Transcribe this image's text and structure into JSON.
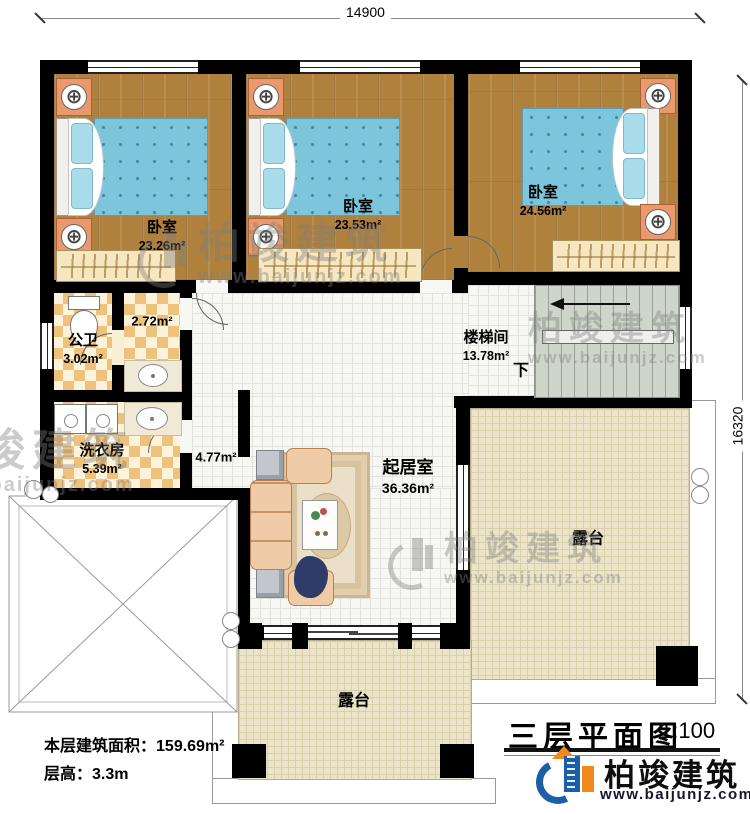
{
  "dimensions": {
    "width_top": "14900",
    "height_right": "16320"
  },
  "rooms": {
    "bedroom1": {
      "name": "卧室",
      "area": "23.26m²"
    },
    "bedroom2": {
      "name": "卧室",
      "area": "23.53m²"
    },
    "bedroom3": {
      "name": "卧室",
      "area": "24.56m²"
    },
    "bathroom": {
      "name": "公卫",
      "area": "3.02m²"
    },
    "vanity": {
      "area": "2.72m²"
    },
    "laundry": {
      "name": "洗衣房",
      "area": "5.39m²"
    },
    "hall": {
      "area": "4.77m²"
    },
    "stairwell": {
      "name": "楼梯间",
      "area": "13.78m²",
      "down_label": "下"
    },
    "living": {
      "name": "起居室",
      "area": "36.36m²"
    },
    "terrace_right": {
      "name": "露台"
    },
    "terrace_bottom": {
      "name": "露台"
    }
  },
  "footer": {
    "area_label": "本层建筑面积：",
    "area_value": "159.69m²",
    "height_label": "层高：",
    "height_value": "3.3m"
  },
  "title_block": {
    "title": "三层平面图",
    "scale": "1:100",
    "brand": "柏竣建筑",
    "website": "www.baijunjz.com"
  },
  "watermark": {
    "brand": "柏竣建筑",
    "website": "www.baijunjz.com"
  },
  "icons": {
    "lamp": "⊕"
  },
  "colors": {
    "wall": "#000000",
    "wood_floor": "#b0813d",
    "tile_accent": "#eec27c",
    "living_floor": "#f7f7f4",
    "terrace_floor": "#ece4c9",
    "stairs": "#ced5ca",
    "bed": "#7cc5da",
    "logo_blue": "#1c5fa8",
    "logo_orange": "#f18a1d"
  }
}
